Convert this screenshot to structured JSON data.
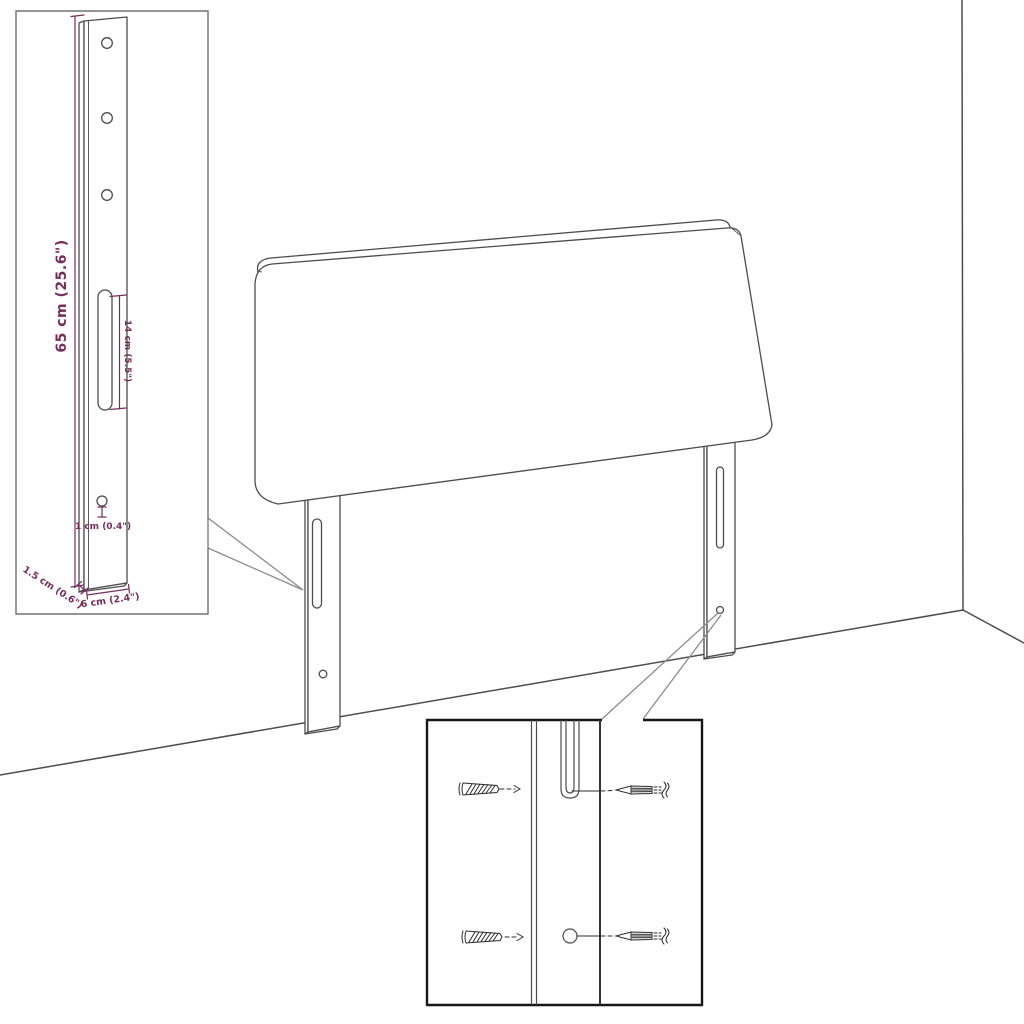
{
  "diagram": {
    "kind": "product-dimension-line-drawing",
    "subject": "headboard-with-mounting-legs",
    "colors": {
      "background": "#ffffff",
      "outline": "#4d4d4d",
      "dimension_text": "#772d5c",
      "detail_box_border": "#161616"
    },
    "dimensions": {
      "overall_height": "65 cm (25.6\")",
      "slot_length": "14 cm (5.5\")",
      "hole_diameter": "1 cm (0.4\")",
      "leg_thickness": "1.5 cm (0.6\")",
      "leg_width": "6 cm (2.4\")"
    }
  }
}
